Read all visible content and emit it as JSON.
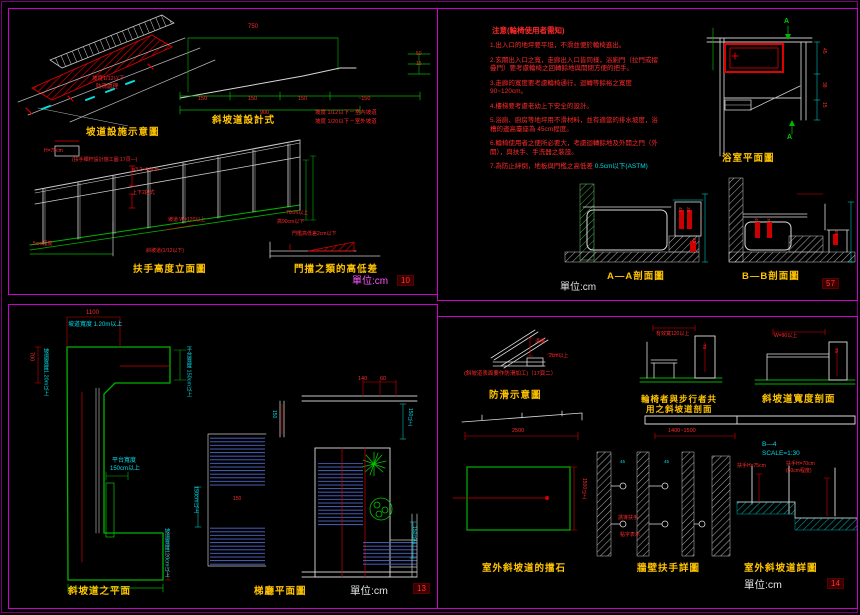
{
  "q1": {
    "iso_title": "坡道設施示意圖",
    "iso_note1": "坡度1/12以下",
    "iso_note2": "防滑處理",
    "profile_title": "斜坡道設計式",
    "formula1": "坡度 1/12以下－室內坡道",
    "formula2": "坡度 1/20以下－室外坡道",
    "dim_top": "750",
    "seg1": "150",
    "seg2": "150",
    "seg3": "150",
    "seg4": "~150",
    "dim_total": "900",
    "dim_r1": "50",
    "dim_r2": "15",
    "rail_title": "扶手高度立面圖",
    "rail_h": "H=75cm",
    "rail_note": "(扶手欄杆設計施工圖 17頁—)",
    "rail_ann1": "φ3.2~4.8cm",
    "rail_ann2": "上下2段式",
    "rail_slope": "坡道 W=120以上",
    "rail_grade": "斜坡道(1/12以下)",
    "rail_left": "5cm程度",
    "rail_r1": "70cm以上",
    "rail_r2": "高90cm以下",
    "door_note": "門檻高低差2cm以下",
    "door_title": "門擋之類的高低差",
    "unit": "單位:cm",
    "badge": "10"
  },
  "q2": {
    "notes_title": "注意(輪椅使用者需知)",
    "note1": "1.出入口的地坪要平坦，不滑並便於輪椅進出。",
    "note2": "2.玄關出入口之寬，走廊出入口皆同樣，浴廁門（拉門或摺疊門）要考慮輪椅之回轉餘地與開閉方便的把手。",
    "note3": "3.走廊的寬度要考慮輪椅通行，迴轉等餘裕之寬度 90~120cm。",
    "note4": "4.樓梯要考慮老幼上下安全的設計。",
    "note5": "5.浴廁、廚房等地坪用不滑材料，並有適當的排水坡度，浴槽的邊高臺座為 45cm程度。",
    "note6": "6.輪椅使用者之便所必要大，考慮迴轉餘地及外開之門（外開），與扶手、手洗器之裝設。",
    "note7_red": "7.為防止絆倒，地板與門檻之高低差 ",
    "note7_cyan": "0.5cm以下(ASTM)",
    "plan_title": "浴室平面圖",
    "marker_top": "A",
    "marker_bottom": "A",
    "plan_d1": "45",
    "plan_d2": "38",
    "plan_d3": "15",
    "secA_title": "A—A剖面圖",
    "secB_title": "B—B剖面圖",
    "secA_d1": "45",
    "secA_d2": "38",
    "secA_d3": "35",
    "secB_d1": "45",
    "secB_d2": "70",
    "secB_d3": "35",
    "unit": "單位:cm",
    "badge": "57"
  },
  "q3": {
    "plan1_title": "斜坡道之平面",
    "ann_top": "坡道寬度 1.20m以上",
    "ann_left": "坡道寬度1.20m以上",
    "ann_right": "平台寬度 150cm以上",
    "ann_mid1": "平台寬度",
    "ann_mid2": "150cm以上",
    "ann_bottom": "坡道寬度120cm以上",
    "dim_top": "1100",
    "dim_left": "700",
    "stair_ann": "150cm以上",
    "stair_d": "150",
    "plan2_title": "梯廳平面圖",
    "dim_a": "140",
    "dim_b": "60",
    "dim_c": "150",
    "ann_r1": "150以上",
    "ann_r2": "150以上",
    "unit": "單位:cm",
    "badge": "13"
  },
  "q4": {
    "slip_title": "防滑示意圖",
    "slip_note": "(斜坡道表面要作防滑加工)（17頁二）",
    "slip_a1": "溝槽",
    "slip_a2": "2cm以上",
    "share_t1": "輪椅者與步行者共",
    "share_t2": "用之斜坡道剖面",
    "share_d": "有效寬120以上",
    "share_h": "75",
    "width_title": "斜坡道寬度剖面",
    "width_d": "W=90以上",
    "width_h": "75",
    "curb_title": "室外斜坡道的擋石",
    "curb_d1": "2500",
    "curb_d2": "1500以上",
    "bar_d": "1400~1500",
    "wall_title": "牆壁扶手詳圖",
    "wall_a1": "誘導扶手",
    "wall_a2": "點字表示",
    "wall_h1": "45",
    "wall_h2": "45",
    "ref": "B—4",
    "scale": "SCALE=1:30",
    "det_l": "扶手H=75cm",
    "det_r1": "扶手H=70cm",
    "det_r2": "(50cm程度)",
    "det_title": "室外斜坡道詳圖",
    "unit": "單位:cm",
    "badge": "14"
  }
}
